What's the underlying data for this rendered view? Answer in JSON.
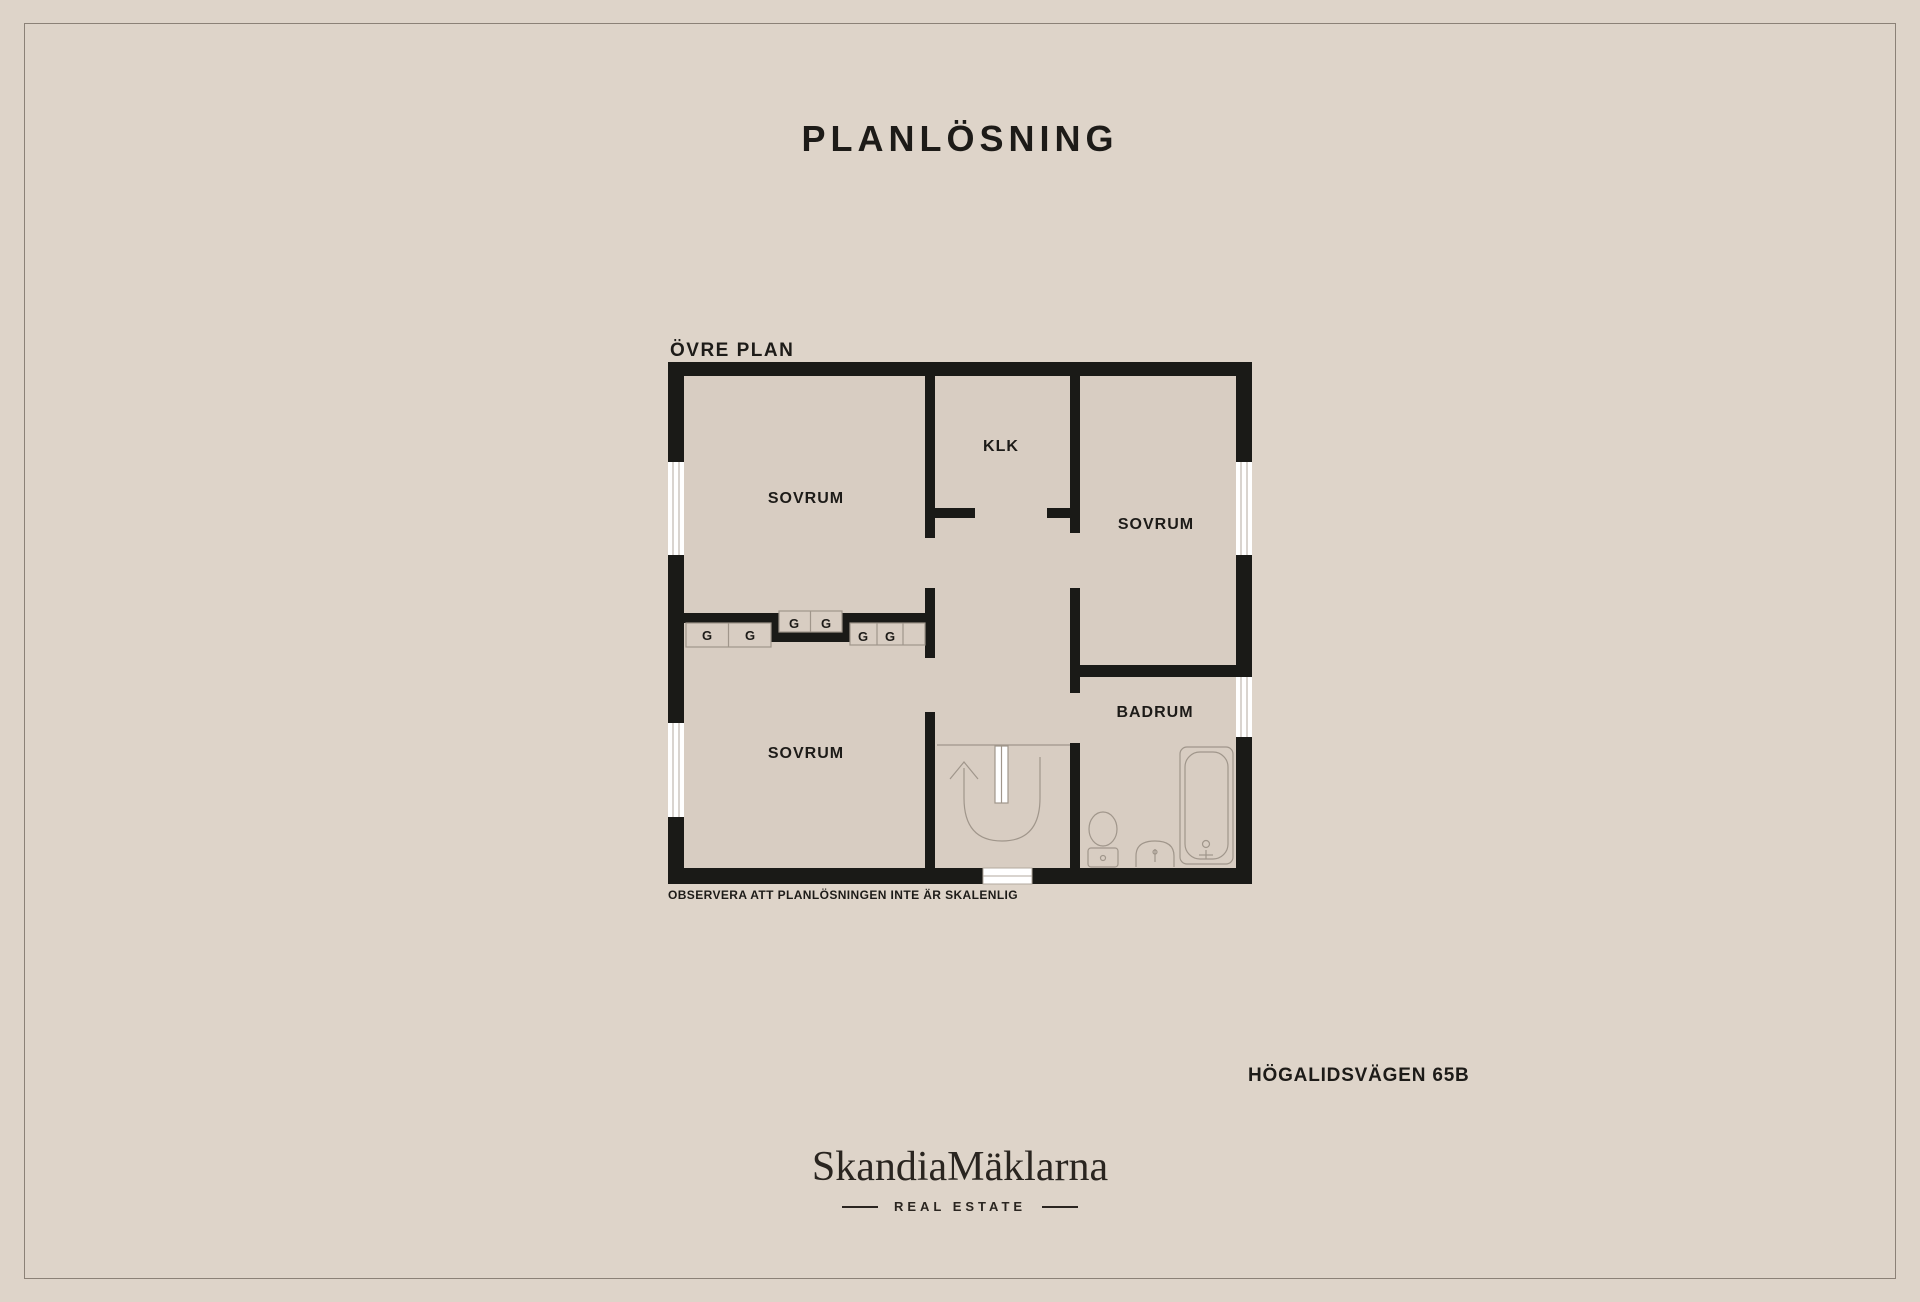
{
  "page": {
    "title": "PLANLÖSNING",
    "disclaimer": "OBSERVERA ATT PLANLÖSNINGEN INTE ÄR SKALENLIG",
    "address": "HÖGALIDSVÄGEN 65B"
  },
  "floorplan": {
    "floor_label": "ÖVRE PLAN",
    "rooms": {
      "bedroom_top_left": {
        "label": "SOVRUM"
      },
      "closet": {
        "label": "KLK"
      },
      "bedroom_right": {
        "label": "SOVRUM"
      },
      "bedroom_bottom_left": {
        "label": "SOVRUM"
      },
      "bathroom": {
        "label": "BADRUM"
      }
    },
    "wardrobe_unit_label": "G",
    "wardrobe_unit_count": 6
  },
  "branding": {
    "logo": "SkandiaMäklarna",
    "tagline": "REAL ESTATE"
  },
  "colors": {
    "background": "#ded4c9",
    "floor": "#d8cdc2",
    "wall": "#1a1a17",
    "fixture_line": "#a0968b",
    "text": "#1d1b18"
  }
}
